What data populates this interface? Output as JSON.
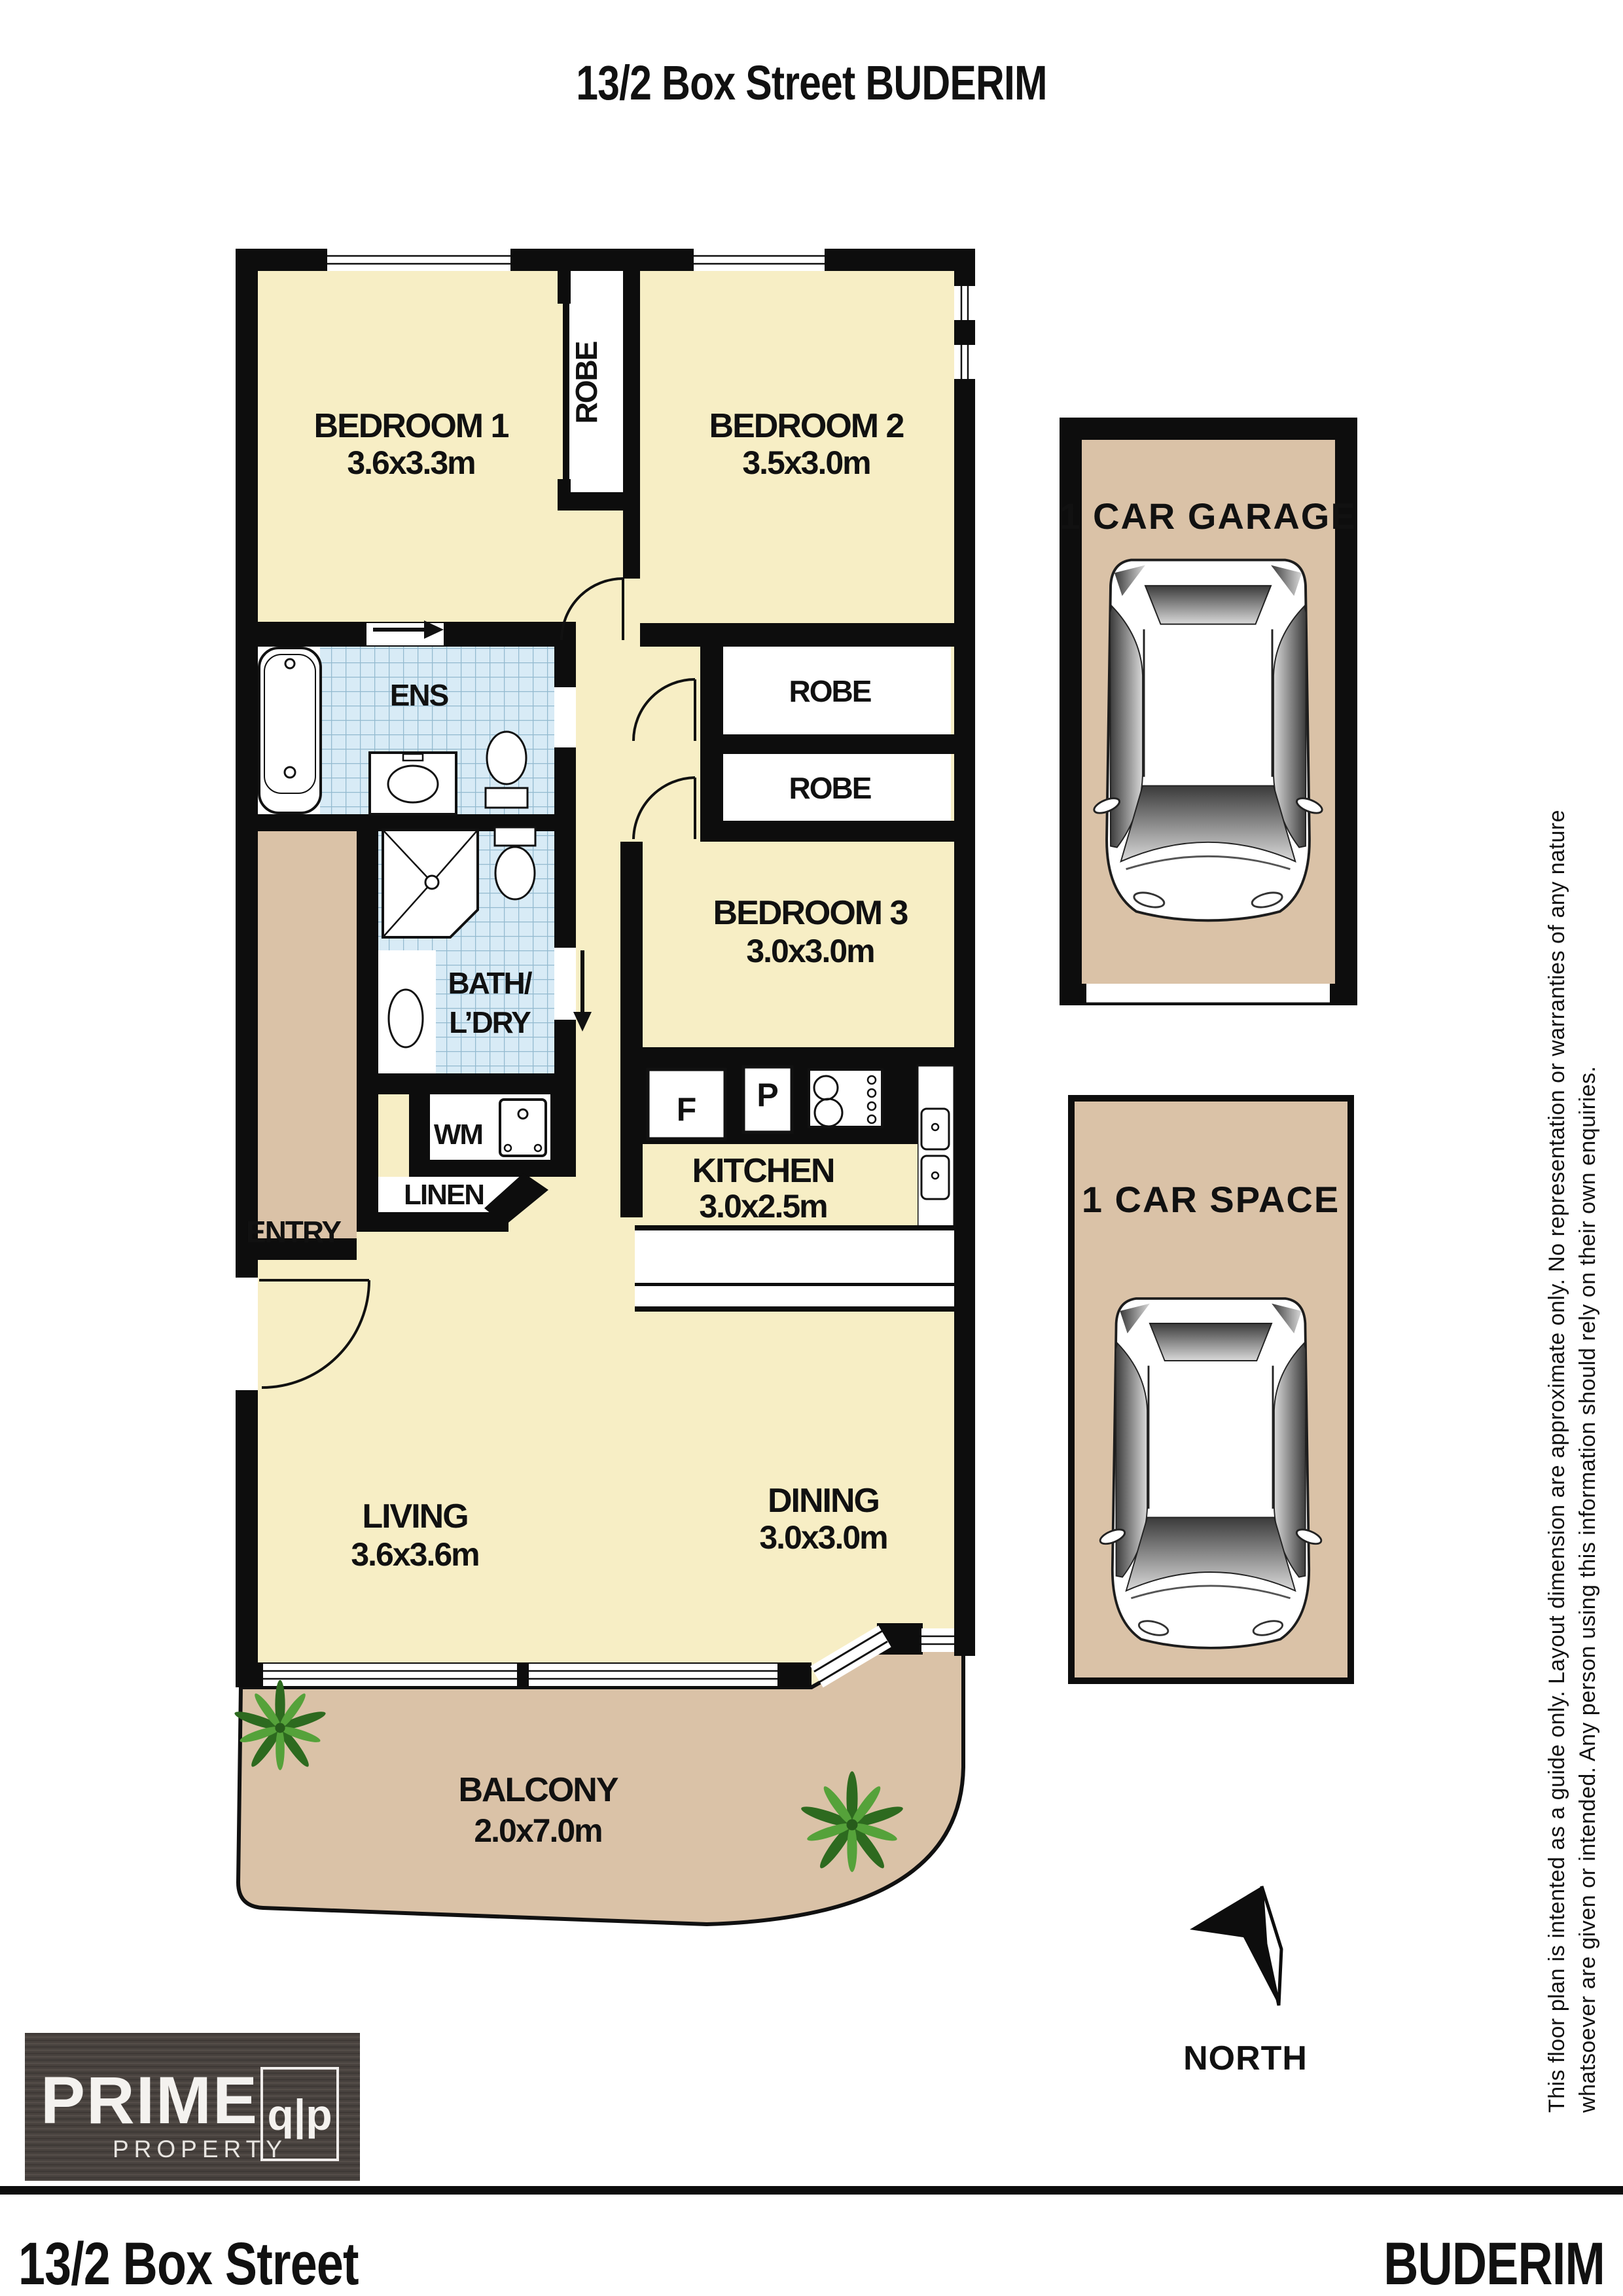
{
  "title": "13/2 Box Street BUDERIM",
  "rooms": {
    "bedroom1": {
      "name": "BEDROOM 1",
      "dims": "3.6x3.3m"
    },
    "bedroom2": {
      "name": "BEDROOM 2",
      "dims": "3.5x3.0m"
    },
    "bedroom3": {
      "name": "BEDROOM 3",
      "dims": "3.0x3.0m"
    },
    "kitchen": {
      "name": "KITCHEN",
      "dims": "3.0x2.5m"
    },
    "living": {
      "name": "LIVING",
      "dims": "3.6x3.6m"
    },
    "dining": {
      "name": "DINING",
      "dims": "3.0x3.0m"
    },
    "balcony": {
      "name": "BALCONY",
      "dims": "2.0x7.0m"
    }
  },
  "labels": {
    "ens": "ENS",
    "bath_line1": "BATH/",
    "bath_line2": "L’DRY",
    "robe_strip": "ROBE",
    "robe_top": "ROBE",
    "robe_bottom": "ROBE",
    "wm": "WM",
    "linen": "LINEN",
    "entry": "ENTRY",
    "fridge": "F",
    "pantry": "P"
  },
  "parking": {
    "garage": "1 CAR GARAGE",
    "car_space": "1 CAR SPACE"
  },
  "compass": {
    "north": "NORTH"
  },
  "disclaimer": {
    "line1": "This floor plan is intented as a guide only. Layout dimension are approximate only. No representation or warranties of any nature",
    "line2": "whatsoever are given or intended. Any person using this information should rely on their own enquiries."
  },
  "logo": {
    "name": "PRIME",
    "sub": "PROPERTY",
    "monogram": "q|p"
  },
  "footer": {
    "left": "13/2 Box Street",
    "right": "BUDERIM"
  },
  "colors": {
    "room_fill": "#f7eec5",
    "outdoor_fill": "#dac2a7",
    "tile_fill": "#d8ebf6",
    "tile_grid": "#93bacf",
    "wall": "#0d0d0d",
    "logo_bg": "#48423e"
  }
}
